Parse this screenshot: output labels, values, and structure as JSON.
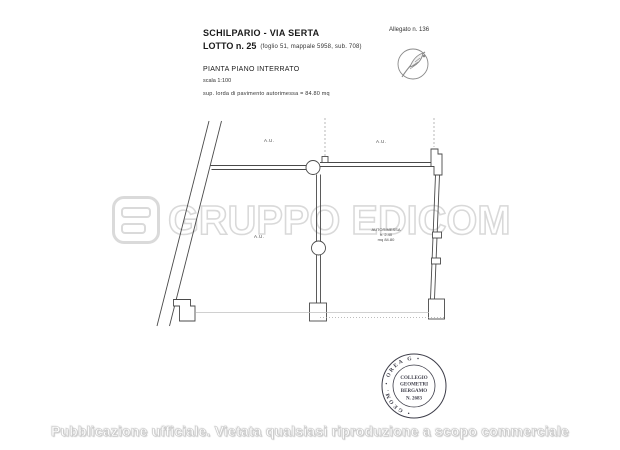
{
  "header": {
    "location": "SCHILPARIO - VIA SERTA",
    "lot_title": "LOTTO n. 25",
    "lot_details": "(foglio 51, mappale 5958, sub. 708)",
    "allegato": "Allegato n. 136",
    "plan_title": "PIANTA PIANO INTERRATO",
    "scale": "scala 1:100",
    "surface_note": "sup. lorda di pavimento autorimessa  =   84.80  mq"
  },
  "plan": {
    "labels": [
      {
        "text": "A.U."
      },
      {
        "text": "A.U."
      },
      {
        "text": "A.U."
      }
    ],
    "room_label": {
      "lines": [
        "AUTORIMESSA",
        "h. 2.40",
        "mq 84.80"
      ]
    }
  },
  "watermark": {
    "text": "GRUPPO EDICOM",
    "logo_name": "edicom-logo",
    "color": "#d9d9d9"
  },
  "stamp": {
    "ring_text": "•  GEOM.  •  OREA  G  •",
    "center_lines": [
      "COLLEGIO",
      "GEOMETRI",
      "BERGAMO",
      "N. 2683"
    ],
    "ink_color": "#3d3d49"
  },
  "footer": {
    "notice": "Pubblicazione ufficiale. Vietata qualsiasi riproduzione a scopo commerciale"
  }
}
